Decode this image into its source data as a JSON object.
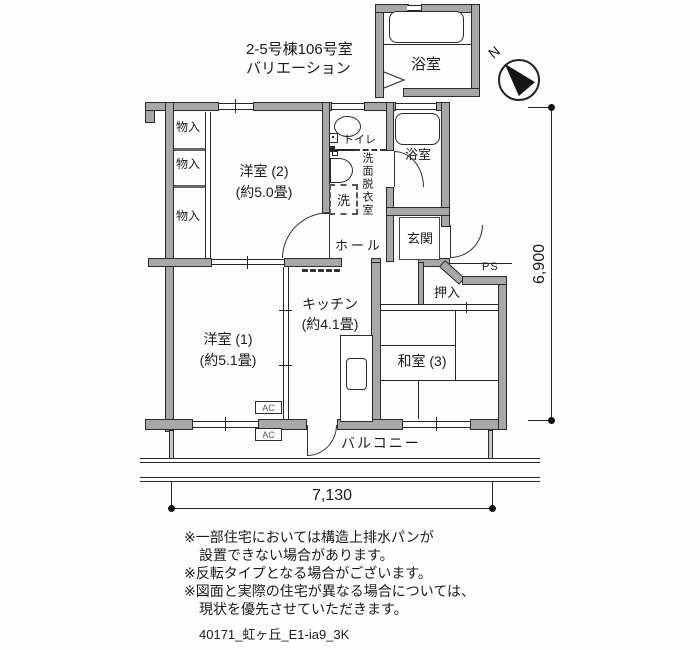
{
  "title": {
    "line1": "2-5号棟106号室",
    "line2": "バリエーション"
  },
  "north_label": "N",
  "rooms": {
    "bath_top": "浴室",
    "bath": "浴室",
    "toilet": "トイレ",
    "washroom": "洗面脱衣室",
    "laundry": "洗",
    "storage": "物入",
    "western2_name": "洋室 (2)",
    "western2_size": "(約5.0畳)",
    "western1_name": "洋室 (1)",
    "western1_size": "(約5.1畳)",
    "kitchen_name": "キッチン",
    "kitchen_size": "(約4.1畳)",
    "japanese3": "和室 (3)",
    "hall": "ホール",
    "genkan": "玄関",
    "ps": "PS",
    "oshiire": "押入",
    "balcony": "バルコニー",
    "ac": "AC"
  },
  "dimensions": {
    "width": "7,130",
    "height": "6,900"
  },
  "notes": [
    "※一部住宅においては構造上排水パンが",
    "設置できない場合があります。",
    "※反転タイプとなる場合がございます。",
    "※図面と実際の住宅が異なる場合については、",
    "現状を優先させていただきます。"
  ],
  "footer": "40171_虹ヶ丘_E1-ia9_3K",
  "colors": {
    "wall_fill": "#a8a8a8",
    "line": "#262626"
  }
}
